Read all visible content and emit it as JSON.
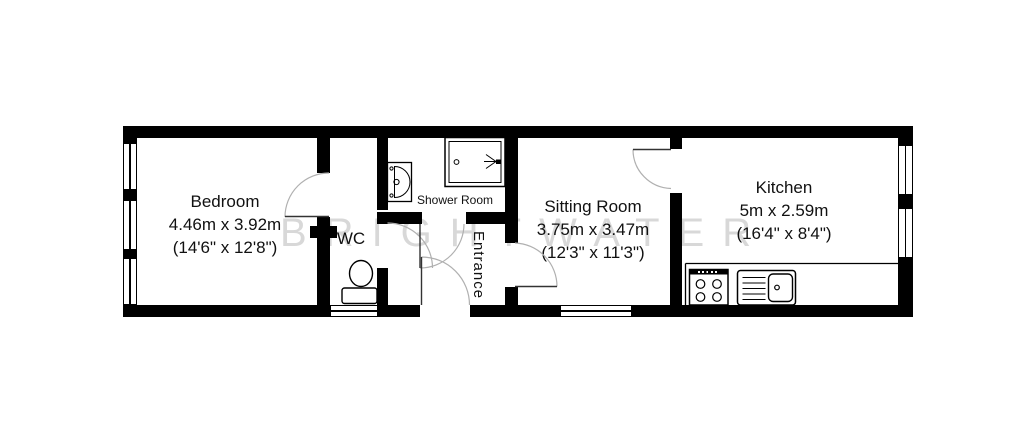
{
  "floorplan": {
    "type": "floor-plan",
    "watermark": "BRIGHTWATER",
    "colors": {
      "wall": "#000000",
      "background": "#ffffff",
      "door_arc": "#b0b0b0",
      "door_leaf": "#333333",
      "watermark": "#d8d8d8",
      "label_text": "#111111"
    },
    "rooms": [
      {
        "id": "bedroom",
        "name": "Bedroom",
        "size_metric": "4.46m x 3.92m",
        "size_imperial": "(14'6\" x 12'8\")"
      },
      {
        "id": "wc",
        "name": "WC",
        "size_metric": "",
        "size_imperial": ""
      },
      {
        "id": "shower-room",
        "name": "Shower Room",
        "size_metric": "",
        "size_imperial": ""
      },
      {
        "id": "entrance",
        "name": "Entrance",
        "size_metric": "",
        "size_imperial": ""
      },
      {
        "id": "sitting-room",
        "name": "Sitting Room",
        "size_metric": "3.75m x 3.47m",
        "size_imperial": "(12'3\" x 11'3\")"
      },
      {
        "id": "kitchen",
        "name": "Kitchen",
        "size_metric": "5m x 2.59m",
        "size_imperial": "(16'4\" x 8'4\")"
      }
    ],
    "fixtures": [
      {
        "id": "washbasin",
        "room": "shower-room"
      },
      {
        "id": "shower-tray",
        "room": "shower-room"
      },
      {
        "id": "toilet",
        "room": "wc"
      },
      {
        "id": "hob",
        "room": "kitchen"
      },
      {
        "id": "sink-drainer",
        "room": "kitchen"
      },
      {
        "id": "worktop",
        "room": "kitchen"
      }
    ]
  }
}
